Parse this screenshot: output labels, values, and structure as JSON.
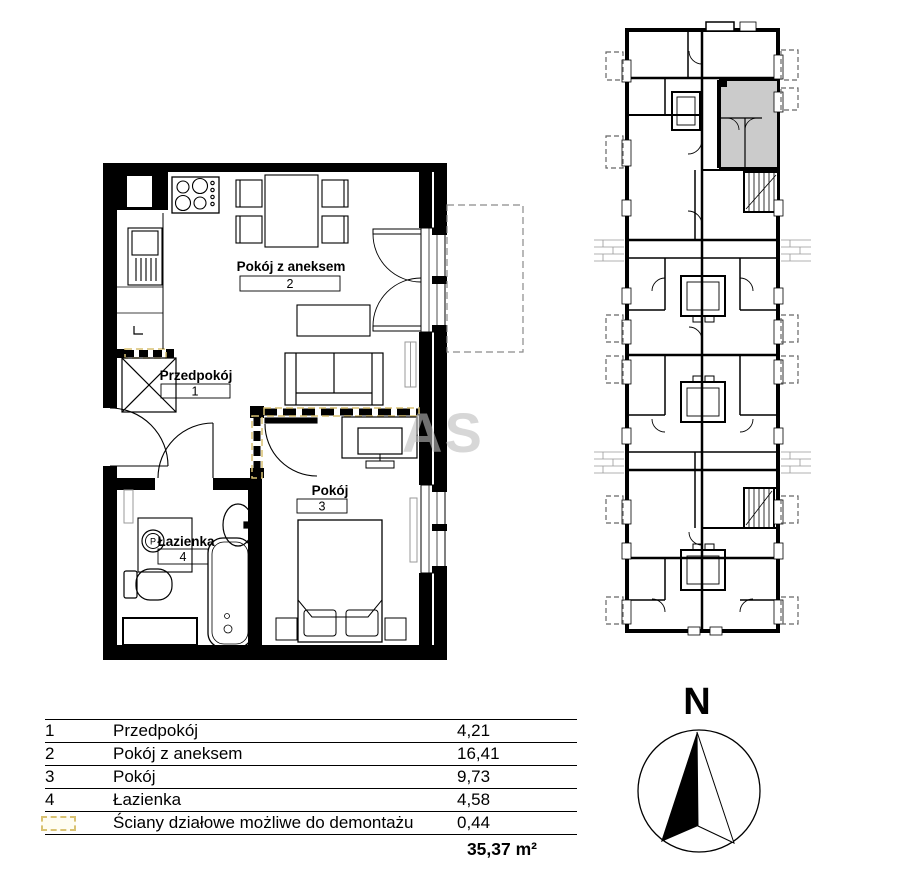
{
  "plan": {
    "rooms": {
      "hall": {
        "label": "Przedpokój",
        "number": "1"
      },
      "living": {
        "label": "Pokój z aneksem",
        "number": "2"
      },
      "bedroom": {
        "label": "Pokój",
        "number": "3"
      },
      "bath": {
        "label": "Łazienka",
        "number": "4"
      }
    },
    "fridge_mark": "L",
    "washer_mark": "P"
  },
  "legend_table": {
    "rows": [
      {
        "no": "1",
        "name": "Przedpokój",
        "area": "4,21"
      },
      {
        "no": "2",
        "name": "Pokój z aneksem",
        "area": "16,41"
      },
      {
        "no": "3",
        "name": "Pokój",
        "area": "9,73"
      },
      {
        "no": "4",
        "name": "Łazienka",
        "area": "4,58"
      },
      {
        "no": "",
        "name": "Ściany działowe możliwe do demontażu",
        "area": "0,44"
      }
    ],
    "total": "35,37 m²"
  },
  "compass": {
    "label": "N"
  },
  "watermark": {
    "text": "AS"
  },
  "colors": {
    "wall": "#000000",
    "demolishable": "#d8c172",
    "highlight_unit": "#cbcbcb"
  }
}
